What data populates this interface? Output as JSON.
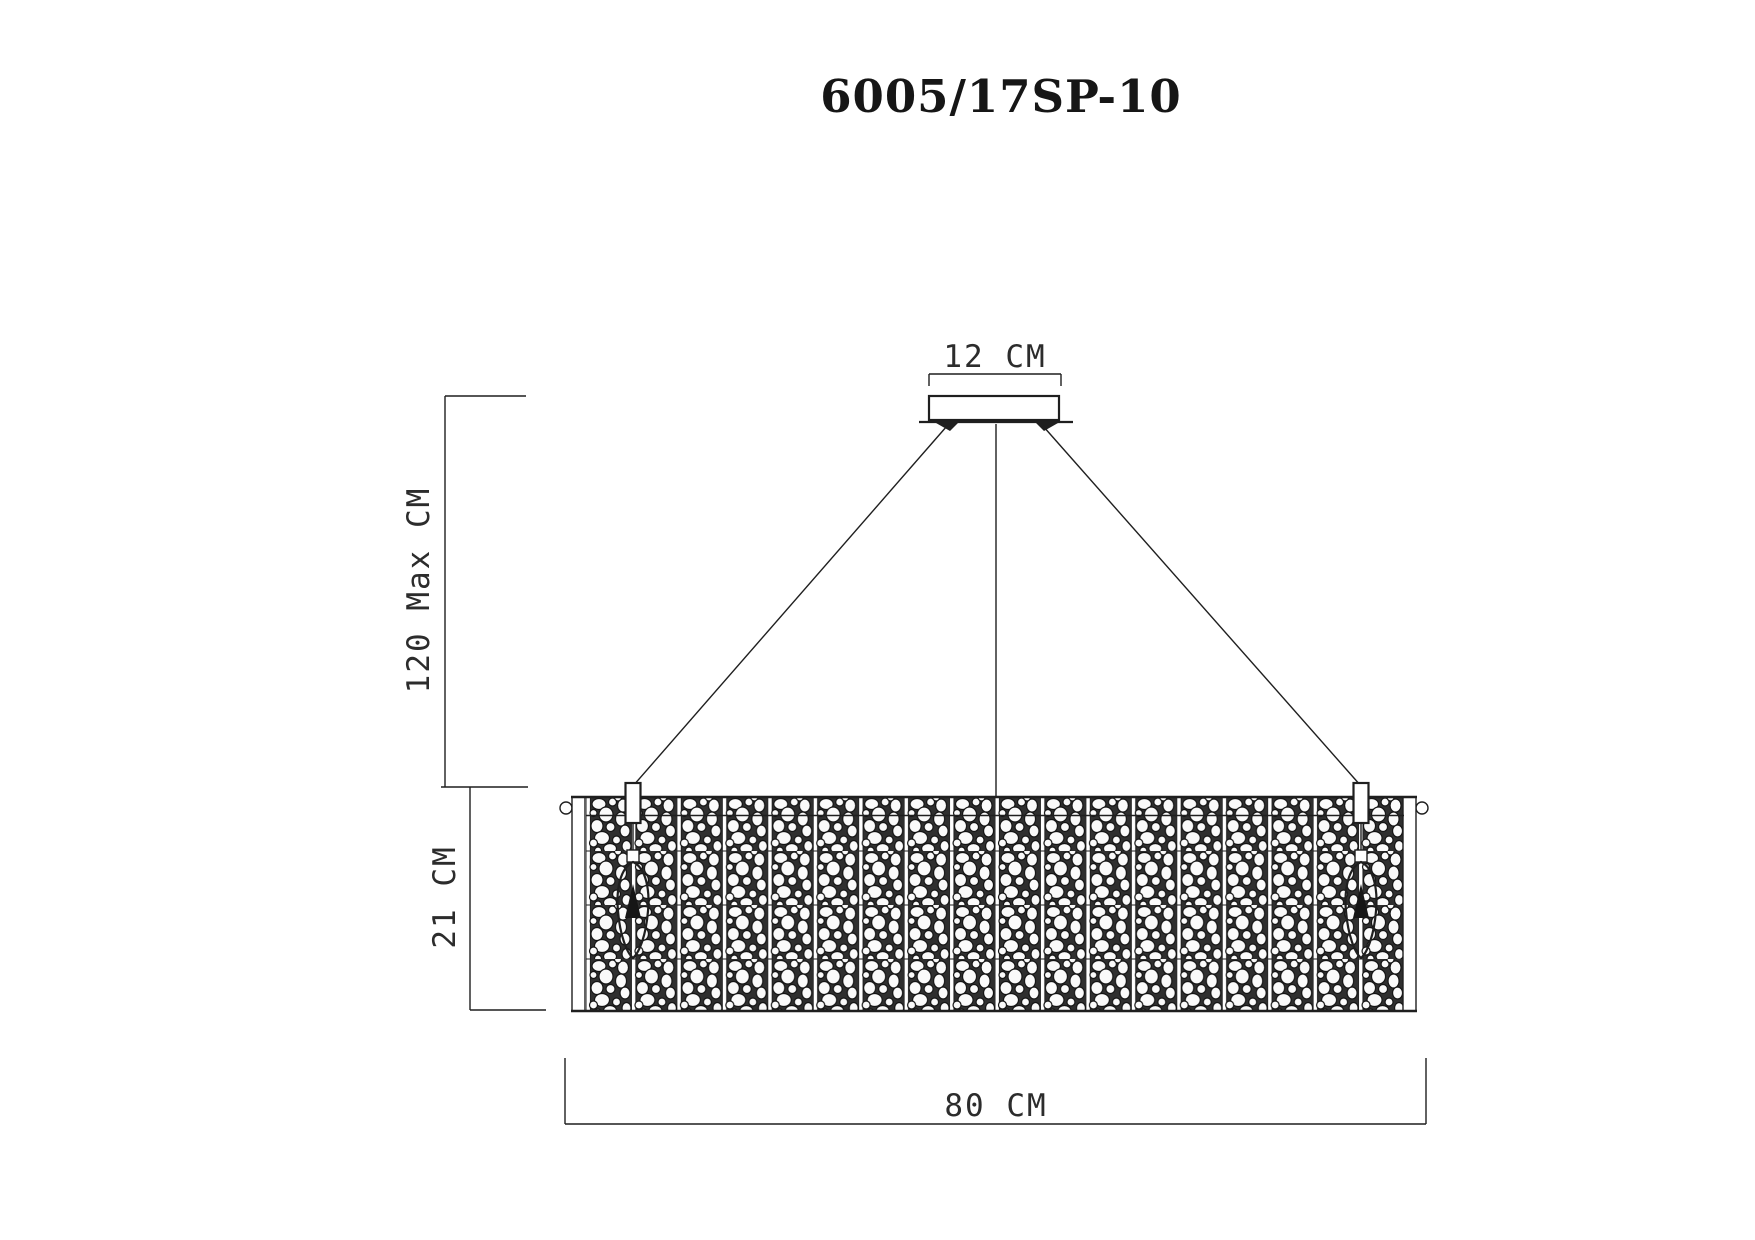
{
  "title": "6005/17SP-10",
  "product": {
    "code": "6005/17SP-10",
    "type": "rectangular crystal pendant chandelier, front elevation technical drawing"
  },
  "labels": {
    "canopy_width": "12 CM",
    "suspension_height": "120 Max CM",
    "body_height": "21 CM",
    "body_width": "80 CM"
  },
  "colors": {
    "background": "#ffffff",
    "ink": "#1f1f1f",
    "mesh_gap": "#2f2f2f",
    "crystal": "#fafafa"
  }
}
